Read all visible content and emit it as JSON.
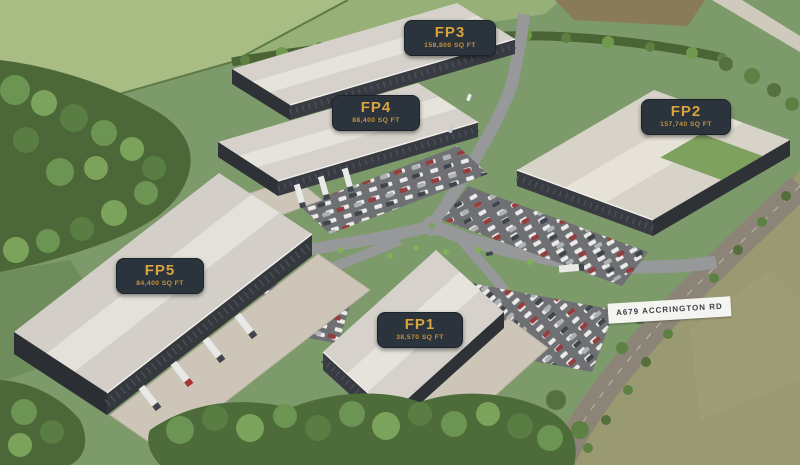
{
  "buildings": [
    {
      "id": "fp1",
      "code": "FP1",
      "area": "38,570 SQ FT"
    },
    {
      "id": "fp2",
      "code": "FP2",
      "area": "157,740 SQ FT"
    },
    {
      "id": "fp3",
      "code": "FP3",
      "area": "158,800 SQ FT"
    },
    {
      "id": "fp4",
      "code": "FP4",
      "area": "88,400 SQ FT"
    },
    {
      "id": "fp5",
      "code": "FP5",
      "area": "84,400 SQ FT"
    }
  ],
  "road_label": {
    "text": "A679 ACCRINGTON RD"
  },
  "colors": {
    "label_bg": "#2b333d",
    "label_text_gold": "#d9a43b",
    "road_label_bg": "#f4f4f1",
    "road_label_text": "#3b4046",
    "roof": "#d6d2cb",
    "wall": "#383c42",
    "grass": "#7d9a6b"
  }
}
